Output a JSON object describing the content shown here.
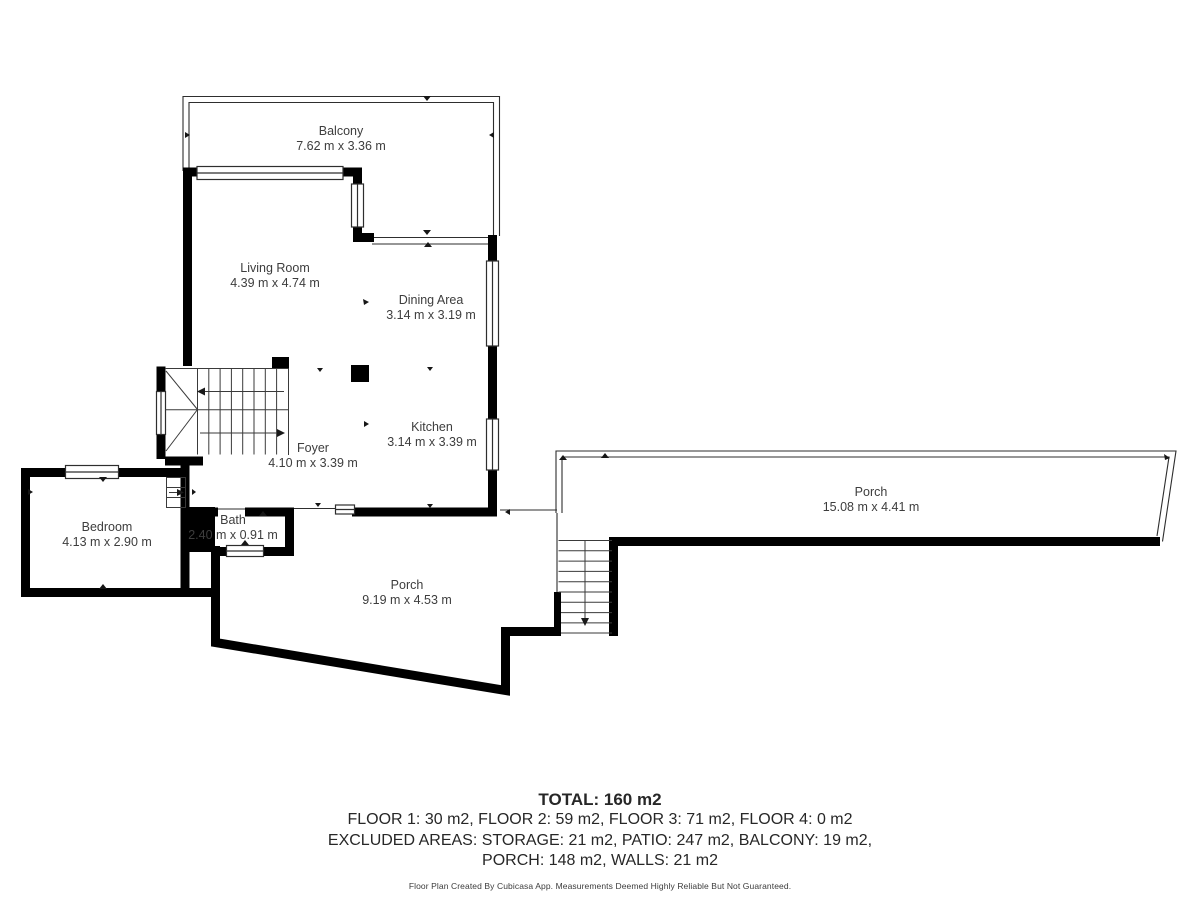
{
  "floorplan": {
    "rooms": [
      {
        "name": "Balcony",
        "dims": "7.62 m x 3.36 m"
      },
      {
        "name": "Living Room",
        "dims": "4.39 m x 4.74 m"
      },
      {
        "name": "Dining Area",
        "dims": "3.14 m x 3.19 m"
      },
      {
        "name": "Kitchen",
        "dims": "3.14 m x 3.39 m"
      },
      {
        "name": "Foyer",
        "dims": "4.10 m x 3.39 m"
      },
      {
        "name": "Bath",
        "dims": "2.40 m x 0.91 m"
      },
      {
        "name": "Bedroom",
        "dims": "4.13 m x 2.90 m"
      },
      {
        "name": "Porch",
        "dims": "9.19 m x 4.53 m"
      },
      {
        "name": "Porch",
        "dims": "15.08 m x 4.41 m"
      }
    ],
    "colors": {
      "wall": "#000000",
      "thin_line": "#2e2e2e",
      "stair_line": "#3a3a3a",
      "text": "#3d3d3d",
      "background": "#ffffff"
    }
  },
  "summary": {
    "total": "TOTAL: 160 m2",
    "floors": "FLOOR 1: 30 m2, FLOOR 2: 59 m2, FLOOR 3: 71 m2, FLOOR 4: 0 m2",
    "excluded_line1": "EXCLUDED AREAS: STORAGE: 21 m2, PATIO: 247 m2, BALCONY: 19 m2,",
    "excluded_line2": "PORCH: 148 m2, WALLS: 21 m2",
    "disclaimer": "Floor Plan Created By Cubicasa App. Measurements Deemed Highly Reliable But Not Guaranteed."
  }
}
